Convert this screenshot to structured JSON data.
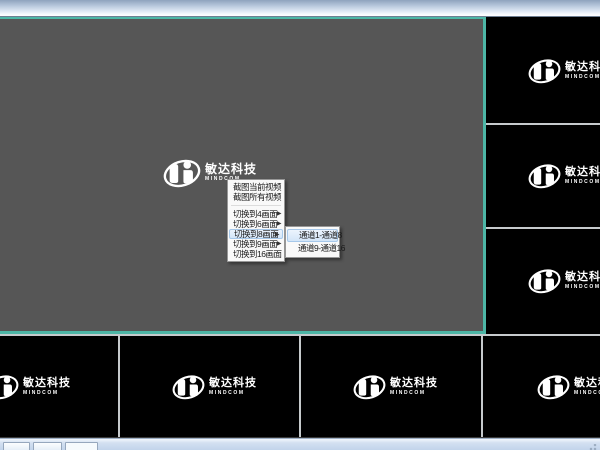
{
  "brand": {
    "title": "敏达科技",
    "subtitle": "MINDCOM"
  },
  "context_menu": {
    "arrow": "▶",
    "items": [
      {
        "label": "截图当前视频",
        "has_submenu": false,
        "highlighted": false
      },
      {
        "label": "截图所有视频",
        "has_submenu": false,
        "highlighted": false
      },
      {
        "label": "切换到4画面",
        "has_submenu": true,
        "highlighted": false
      },
      {
        "label": "切换到6画面",
        "has_submenu": true,
        "highlighted": false
      },
      {
        "label": "切换到8画面",
        "has_submenu": true,
        "highlighted": true
      },
      {
        "label": "切换到9画面",
        "has_submenu": true,
        "highlighted": false
      },
      {
        "label": "切换到16画面",
        "has_submenu": false,
        "highlighted": false
      }
    ],
    "submenu": {
      "items": [
        {
          "label": "通道1-通道8",
          "highlighted": true
        },
        {
          "label": "通道9-通道16",
          "highlighted": false
        }
      ]
    }
  },
  "colors": {
    "selected_panel_border": "#4db6a6",
    "selected_panel_bg": "#565656",
    "video_panel_bg": "#000000",
    "menu_bg": "#f9f9f9",
    "menu_highlight": "#d3e5f8"
  }
}
